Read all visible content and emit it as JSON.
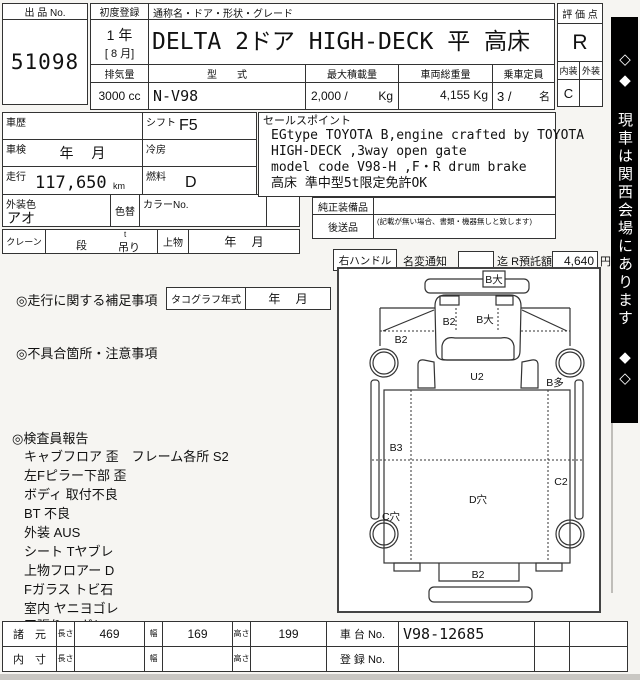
{
  "header": {
    "lot_no_label": "出 品 No.",
    "lot_no": "51098",
    "first_reg_label": "初度登録",
    "first_reg_year": "1 年",
    "first_reg_month": "[ 8 月]",
    "name_header": "通称名・ドア・形状・グレード",
    "title": "DELTA 2ドア HIGH-DECK 平 高床",
    "displacement_label": "排気量",
    "displacement": "3000 cc",
    "model_label": "型　　式",
    "model": "N-V98",
    "max_load_label": "最大積載量",
    "max_load": "2,000 /",
    "max_load_unit": "Kg",
    "gross_weight_label": "車両総重量",
    "gross_weight": "4,155 Kg",
    "capacity_label": "乗車定員",
    "capacity": "3 /",
    "capacity_unit": "名"
  },
  "score": {
    "label": "評 価 点",
    "value": "R",
    "interior_label": "内装",
    "exterior_label": "外装",
    "interior_value": "C",
    "exterior_value": ""
  },
  "side_banner": "◇◆ 現車は関西会場にあります ◆◇",
  "info": {
    "history_label": "車歴",
    "shift_label": "シフト",
    "shift_value": "F5",
    "inspection_label": "車検",
    "inspection_value": "年　 月",
    "aircon_label": "冷房",
    "mileage_label": "走行",
    "mileage_value": "117,650",
    "mileage_unit": "km",
    "fuel_label": "燃料",
    "fuel_value": "D",
    "color_label": "外装色",
    "color_value": "アオ",
    "recolor_label": "色替",
    "color_no_label": "カラーNo.",
    "crane_label": "クレーン",
    "crane_dan": "段",
    "crane_t": "t",
    "crane_tsuri": "吊り",
    "crane_body_label": "上物",
    "crane_date": "年　 月"
  },
  "sales": {
    "label": "セールスポイント",
    "lines": [
      "EGtype TOYOTA B,engine crafted by TOYOTA",
      "HIGH-DECK ,3way open gate",
      "model code V98-H ,F・R drum brake",
      "高床 準中型5t限定免許OK"
    ]
  },
  "equipment": {
    "genuine_label": "純正装備品",
    "later_label": "後送品",
    "later_note": "(記載が無い場合、書類・機器無しと致します)"
  },
  "handle": {
    "handle_label": "右ハンドル",
    "namechange_label": "名変通知",
    "made_label": "迄",
    "deposit_label": "R預託額",
    "deposit_value": "4,640",
    "yen_label": "円"
  },
  "notes": {
    "mileage_note_label": "◎走行に関する補足事項",
    "tacho_label": "タコグラフ年式",
    "tacho_value": "年　 月",
    "defect_label": "◎不具合箇所・注意事項"
  },
  "inspector": {
    "label": "◎検査員報告",
    "lines": [
      "キャブフロア 歪　フレーム各所 S2",
      "左Fピラー下部 歪",
      "ボディ 取付不良",
      "BT 不良",
      "外装 AUS",
      "シート Tヤブレ",
      "上物フロアー D",
      "Fガラス トビ石",
      "室内 ヤニヨゴレ",
      "天張り ハガレ"
    ]
  },
  "diagram": {
    "front_bumper": "B大",
    "cab_left": "B2",
    "cab_windshield": "B大",
    "left_fender": "B2",
    "cab_under": "U2",
    "right_front_side": "B多",
    "bed_left_front": "B3",
    "bed_right_rear": "C2",
    "bed_center": "D穴",
    "left_rear_side": "C穴",
    "rear_gate": "B2"
  },
  "spec_table": {
    "spec_label": "諸　元",
    "inner_label": "内　寸",
    "len_label": "長さ",
    "wid_label": "幅",
    "hei_label": "高さ",
    "spec_len": "469",
    "spec_wid": "169",
    "spec_hei": "199",
    "inner_len": "",
    "inner_wid": "",
    "inner_hei": "",
    "chassis_label": "車 台 No.",
    "chassis_no": "V98-12685",
    "reg_label": "登 録 No.",
    "reg_no": ""
  }
}
